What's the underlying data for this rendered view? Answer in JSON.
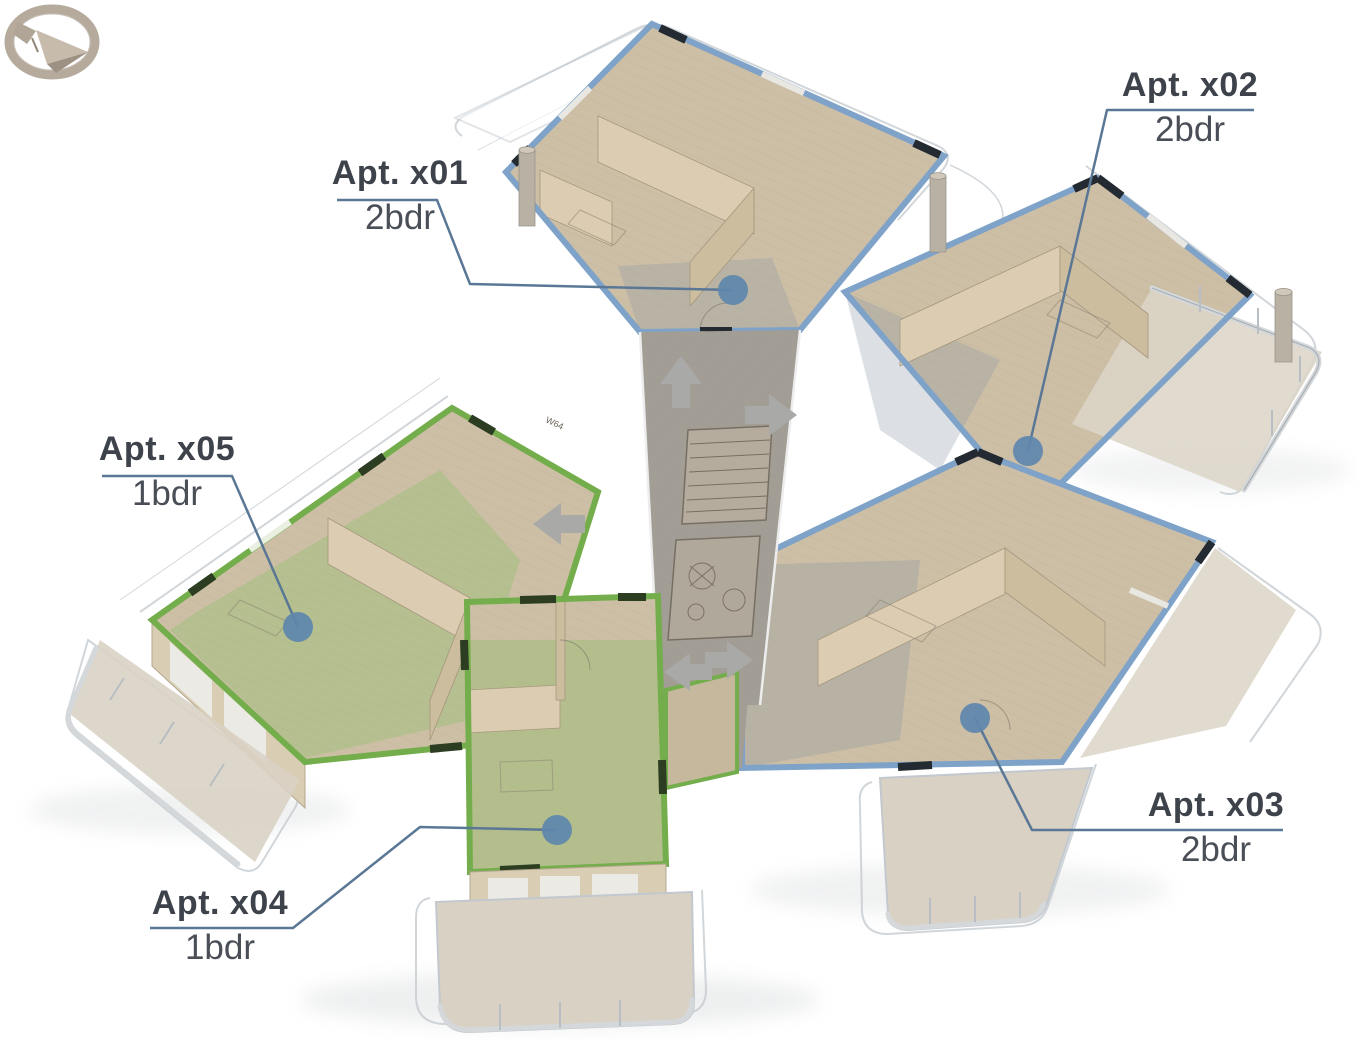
{
  "scene": {
    "kind": "3d-floorplan-render",
    "compass": "north-arrow"
  },
  "apartments": [
    {
      "id": "x01",
      "label": "Apt. x01",
      "type": "2bdr",
      "highlight": "blue"
    },
    {
      "id": "x02",
      "label": "Apt. x02",
      "type": "2bdr",
      "highlight": "blue"
    },
    {
      "id": "x03",
      "label": "Apt. x03",
      "type": "2bdr",
      "highlight": "blue"
    },
    {
      "id": "x04",
      "label": "Apt. x04",
      "type": "1bdr",
      "highlight": "green"
    },
    {
      "id": "x05",
      "label": "Apt. x05",
      "type": "1bdr",
      "highlight": "green"
    }
  ],
  "building": {
    "wall_tags": [
      "W64",
      "W52"
    ]
  },
  "colors": {
    "blue_unit": "#7ea2c8",
    "green_unit": "#74ae4c",
    "marker": "#5e87ad",
    "leader": "#5a7795",
    "label_text": "#3e434b"
  }
}
